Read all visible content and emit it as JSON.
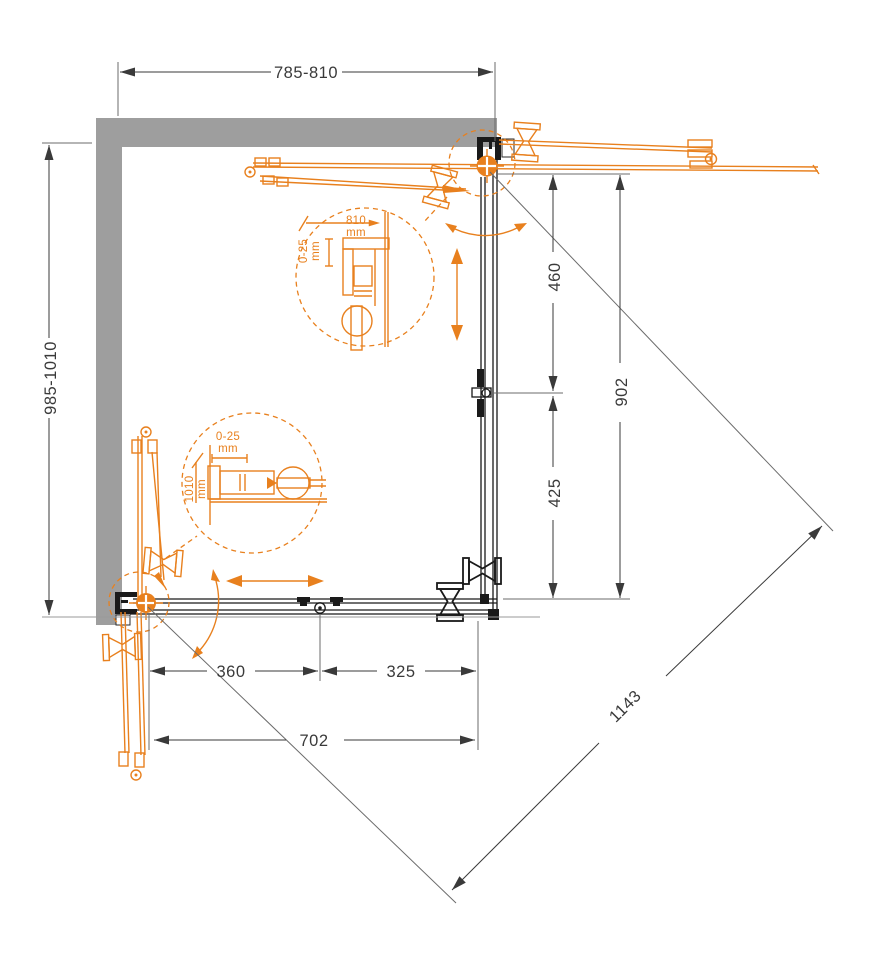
{
  "dims": {
    "width_top": "785-810",
    "height_left": "985-1010",
    "side_upper": "460",
    "side_total": "902",
    "side_lower": "425",
    "bottom_fixed": "360",
    "bottom_door": "325",
    "bottom_opening": "702",
    "diagonal": "1143"
  },
  "detail_top": {
    "width": "810",
    "width_unit": "mm",
    "adjust": "0-25",
    "adjust_unit": "mm"
  },
  "detail_side": {
    "adjust": "0-25",
    "adjust_unit": "mm",
    "height": "1010",
    "height_unit": "mm"
  },
  "colors": {
    "accent": "#E8801E",
    "wall": "#9E9E9E",
    "line": "#3A3A3A"
  }
}
